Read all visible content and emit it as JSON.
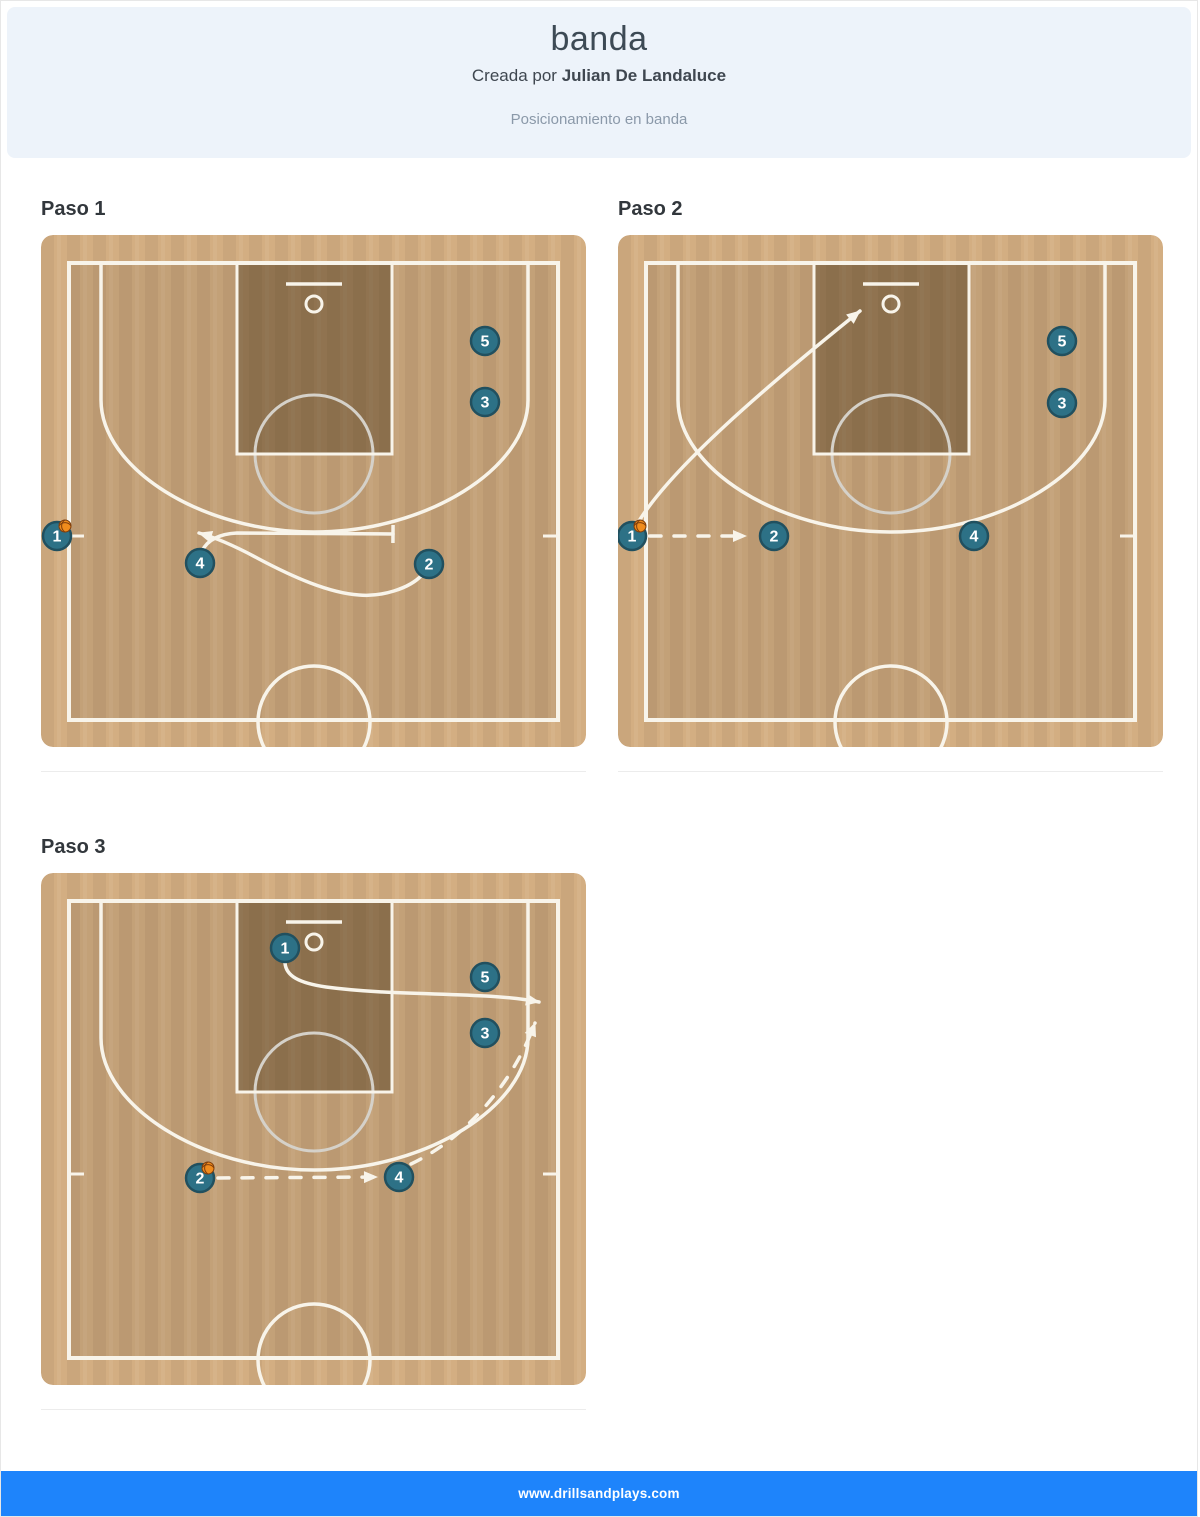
{
  "header": {
    "title": "banda",
    "author_prefix": "Creada por ",
    "author_name": "Julian De Landaluce",
    "subtitle": "Posicionamiento en banda"
  },
  "footer": {
    "url": "www.drillsandplays.com"
  },
  "colors": {
    "header_bg": "#edf3fa",
    "footer_bg": "#1e84fb",
    "wood_light": "#d3ae82",
    "wood_stripe": "rgba(0,0,0,0.045)",
    "interior_shade": "rgba(0,0,0,0.075)",
    "paint_shade": "rgba(60,42,15,0.38)",
    "line": "#f8f4ea",
    "ft_circle": "#d5d1c9",
    "player_fill": "#2d7186",
    "player_stroke": "#21505f",
    "player_text": "#ffffff",
    "ball_fill": "#f08c1d",
    "ball_seam": "#7e3d0c"
  },
  "court": {
    "width": 545,
    "height": 512,
    "radius": 12,
    "boundary": {
      "x": 28,
      "y": 28,
      "w": 489,
      "h": 457
    },
    "paint": {
      "x": 196,
      "y": 28,
      "w": 155,
      "h": 191
    },
    "backboard": {
      "x1": 245,
      "x2": 301,
      "y": 49
    },
    "rim": {
      "cx": 273,
      "cy": 69,
      "r": 8
    },
    "ft_circle": {
      "cx": 273,
      "cy": 219,
      "r": 59
    },
    "three_pt_path": "M 60,28 L 60,165 C 60,233 160,297 273,297 C 386,297 487,233 487,165 L 487,28",
    "center_circle": {
      "cx": 273,
      "cy": 487,
      "r": 56
    },
    "ticks": [
      "M 30,301 l 13,0",
      "M 515,301 l -13,0"
    ]
  },
  "steps": [
    {
      "label": "Paso 1",
      "players": [
        {
          "n": "5",
          "x": 444,
          "y": 106
        },
        {
          "n": "3",
          "x": 444,
          "y": 167
        },
        {
          "n": "1",
          "x": 16,
          "y": 301,
          "ball": true
        },
        {
          "n": "4",
          "x": 159,
          "y": 328
        },
        {
          "n": "2",
          "x": 388,
          "y": 329
        }
      ],
      "lines": [
        {
          "kind": "screen",
          "d": "M 161,316 C 166,306 176,299 196,298 L 352,299",
          "dash": false,
          "end": "bar"
        },
        {
          "kind": "cut",
          "d": "M 381,340 C 368,354 340,362 318,360 C 288,358 252,342 218,324 C 196,312 176,303 158,298",
          "dash": false,
          "end": "arrow"
        }
      ]
    },
    {
      "label": "Paso 2",
      "players": [
        {
          "n": "5",
          "x": 444,
          "y": 106
        },
        {
          "n": "3",
          "x": 444,
          "y": 168
        },
        {
          "n": "1",
          "x": 14,
          "y": 301,
          "ball": true
        },
        {
          "n": "2",
          "x": 156,
          "y": 301
        },
        {
          "n": "4",
          "x": 356,
          "y": 301
        }
      ],
      "lines": [
        {
          "kind": "pass",
          "d": "M 32,301 L 128,301",
          "dash": true,
          "end": "arrow"
        },
        {
          "kind": "cut",
          "d": "M 18,291 C 50,235 150,150 242,76",
          "dash": false,
          "end": "arrow"
        }
      ]
    },
    {
      "label": "Paso 3",
      "players": [
        {
          "n": "1",
          "x": 244,
          "y": 75
        },
        {
          "n": "5",
          "x": 444,
          "y": 104
        },
        {
          "n": "3",
          "x": 444,
          "y": 160
        },
        {
          "n": "2",
          "x": 159,
          "y": 305,
          "ball": true
        },
        {
          "n": "4",
          "x": 358,
          "y": 304
        }
      ],
      "lines": [
        {
          "kind": "cut",
          "d": "M 244,90 C 245,103 258,110 285,114 C 360,124 442,118 498,129",
          "dash": false,
          "end": "arrow"
        },
        {
          "kind": "pass",
          "d": "M 177,305 L 336,304",
          "dash": true,
          "end": "arrow"
        },
        {
          "kind": "pass",
          "d": "M 370,291 C 425,265 472,210 494,150",
          "dash": true,
          "end": "arrow"
        }
      ]
    }
  ]
}
